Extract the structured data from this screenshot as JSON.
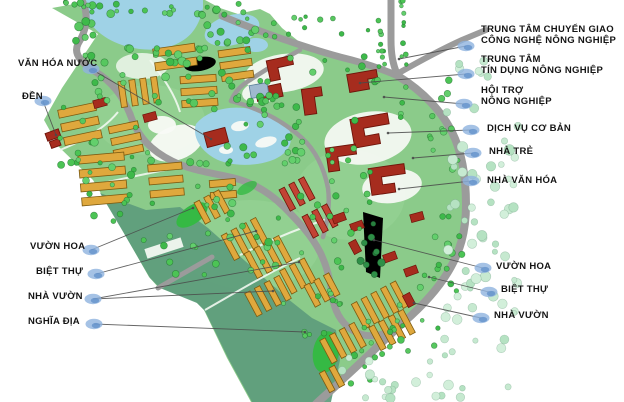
{
  "map": {
    "type": "site-master-plan",
    "colors": {
      "land": "#8bcb8a",
      "land_light": "#9dd69a",
      "land_dark": "#5d9c7c",
      "water": "#9fd2e6",
      "road": "#9b9b9b",
      "path": "#f2f8f1",
      "plaza": "#f8faf6",
      "building_orange": "#dfa83d",
      "building_orange_stroke": "#7c5a10",
      "building_red": "#a62c1e",
      "building_red_stroke": "#6e140a",
      "building_red_row": "#c24334",
      "building_blue": "#9fb9cf",
      "tree_bright": "#4cc455",
      "tree_pale": "#c6e9d0",
      "tree_dark": "#2e8f47",
      "leaf_green": "#35b944",
      "marker": "#8fb3de",
      "marker_dark": "#5b8cc8",
      "leader": "#4a4a4a",
      "label_text": "#141414"
    }
  },
  "labels": {
    "left": [
      {
        "id": "van-hoa-nuoc",
        "text": "VĂN HÓA NƯỚC"
      },
      {
        "id": "den",
        "text": "ĐỀN"
      },
      {
        "id": "vuon-hoa",
        "text": "VƯỜN HOA"
      },
      {
        "id": "biet-thu",
        "text": "BIỆT THỰ"
      },
      {
        "id": "nha-vuon",
        "text": "NHÀ VƯỜN"
      },
      {
        "id": "nghia-dia",
        "text": "NGHĨA ĐỊA"
      }
    ],
    "right": [
      {
        "id": "trung-tam-chuyen-giao",
        "line1": "TRUNG TÂM CHUYỂN GIAO",
        "line2": "CÔNG NGHỆ NÔNG NGHIỆP"
      },
      {
        "id": "trung-tam-tin-dung",
        "line1": "TRUNG TÂM",
        "line2": "TÍN DỤNG NÔNG NGHIỆP"
      },
      {
        "id": "hoi-tro",
        "line1": "HỘI TRỢ",
        "line2": "NÔNG NGHIỆP"
      },
      {
        "id": "dich-vu-co-ban",
        "text": "DỊCH VỤ CƠ BẢN"
      },
      {
        "id": "nha-tre",
        "text": "NHÀ TRẺ"
      },
      {
        "id": "nha-van-hoa",
        "text": "NHÀ VĂN HÓA"
      },
      {
        "id": "vuon-hoa",
        "text": "VƯỜN HOA"
      },
      {
        "id": "biet-thu",
        "text": "BIỆT THỰ"
      },
      {
        "id": "nha-vuon",
        "text": "NHÀ VƯỜN"
      }
    ]
  }
}
